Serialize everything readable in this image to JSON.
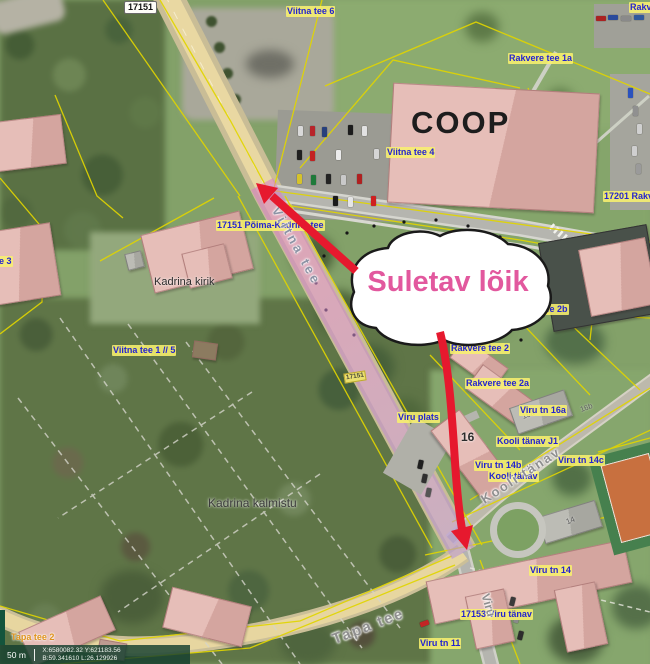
{
  "callout": {
    "text": "Suletav lõik"
  },
  "scalebar": {
    "scale": "50 m",
    "coord_line1": "X:6580082.32 Y:621183.56",
    "coord_line2": "B:59.341610 L:26.129926"
  },
  "colors": {
    "closed_section_overlay": "#c77fc6",
    "annotation_red": "#e6192e",
    "callout_pink": "#e2589e",
    "cadastral_yellow": "#e1d500",
    "address_label_blue": "#2424cf"
  },
  "landmarks": {
    "coop": "COOP",
    "church": "Kadrina kirik",
    "cemetery": "Kadrina kalmistu",
    "house_16": "16",
    "house_14": "14",
    "house_16a": "16a",
    "house_16b": "16b"
  },
  "roads": {
    "badge_top": "17151",
    "badge_on_road": "17151",
    "viitna": "Viitna tee",
    "tapa": "Tapa tee",
    "kooli": "Kooli tänav",
    "viru": "Viru"
  },
  "addresses": [
    {
      "text": "Viitna tee 6"
    },
    {
      "text": "Rakver"
    },
    {
      "text": "Rakvere tee 1a"
    },
    {
      "text": "Viitna tee 4"
    },
    {
      "text": "17201 Rakv"
    },
    {
      "text": "17151 Põima-Kadrina tee"
    },
    {
      "text": "tee 3"
    },
    {
      "text": "Viitna tee 1 // 5"
    },
    {
      "text": "Rakvere tee 2b"
    },
    {
      "text": "Rakvere tee 2"
    },
    {
      "text": "Rakvere tee 2a"
    },
    {
      "text": "Viru tn 16a"
    },
    {
      "text": "Viru plats"
    },
    {
      "text": "Kooli tänav J1"
    },
    {
      "text": "Viru tn 14b"
    },
    {
      "text": "Kooli tänav"
    },
    {
      "text": "Viru tn 14c"
    },
    {
      "text": "Viru tn 14"
    },
    {
      "text": "17153 Viru tänav"
    },
    {
      "text": "Viru tn 11"
    },
    {
      "text": "Tapa tee 2"
    }
  ]
}
